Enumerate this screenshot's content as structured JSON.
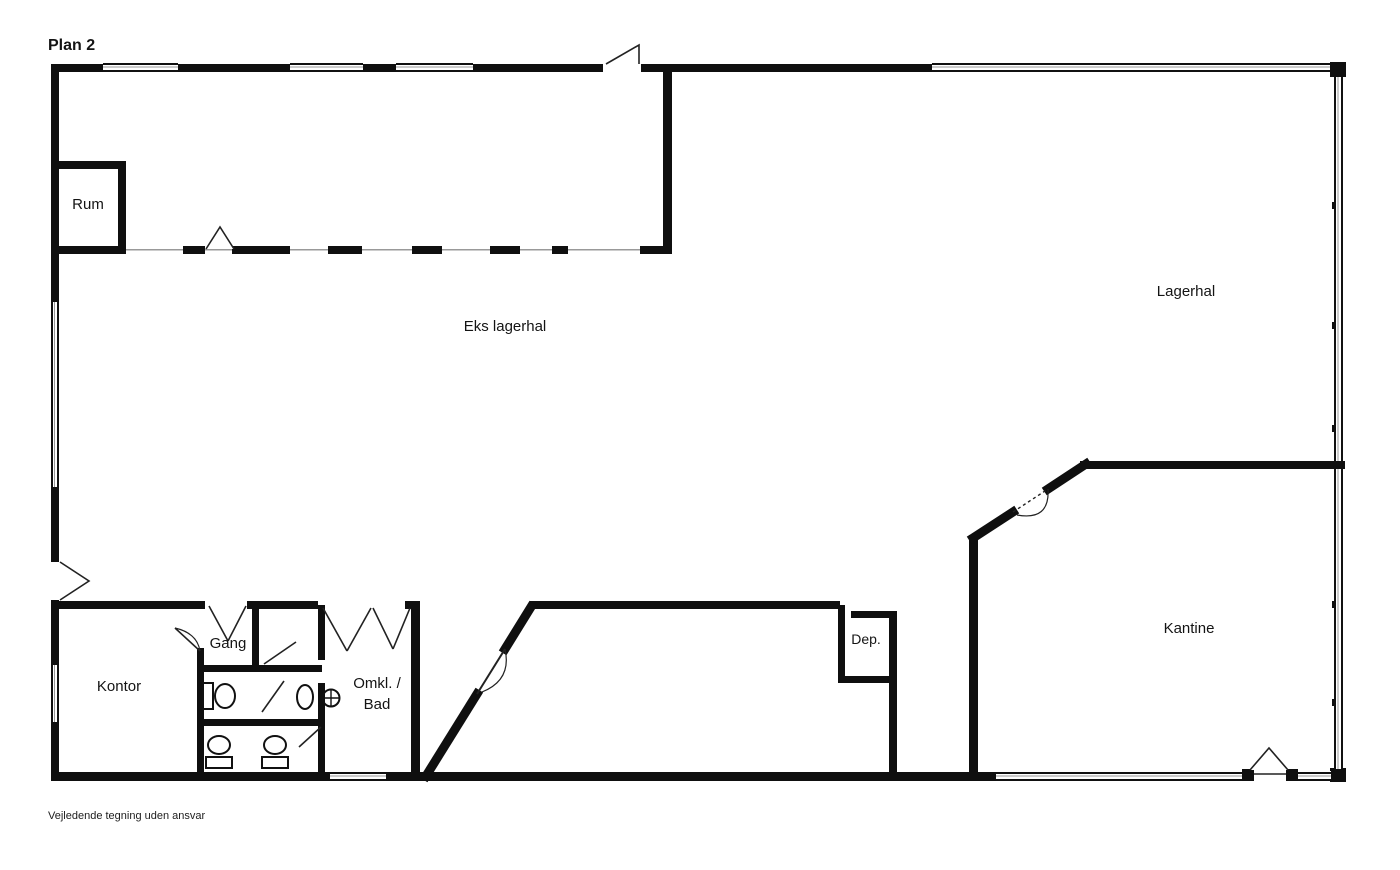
{
  "document": {
    "title": "Plan 2",
    "disclaimer": "Vejledende tegning uden ansvar"
  },
  "rooms": {
    "rum": "Rum",
    "eks_lagerhal": "Eks lagerhal",
    "lagerhal": "Lagerhal",
    "kontor": "Kontor",
    "gang": "Gang",
    "omkl_bad_line1": "Omkl. /",
    "omkl_bad_line2": "Bad",
    "dep": "Dep.",
    "kantine": "Kantine"
  },
  "colors": {
    "wall": "#0f0f0f",
    "background": "#ffffff",
    "window_line": "#111111",
    "window_center_line": "#999999"
  }
}
